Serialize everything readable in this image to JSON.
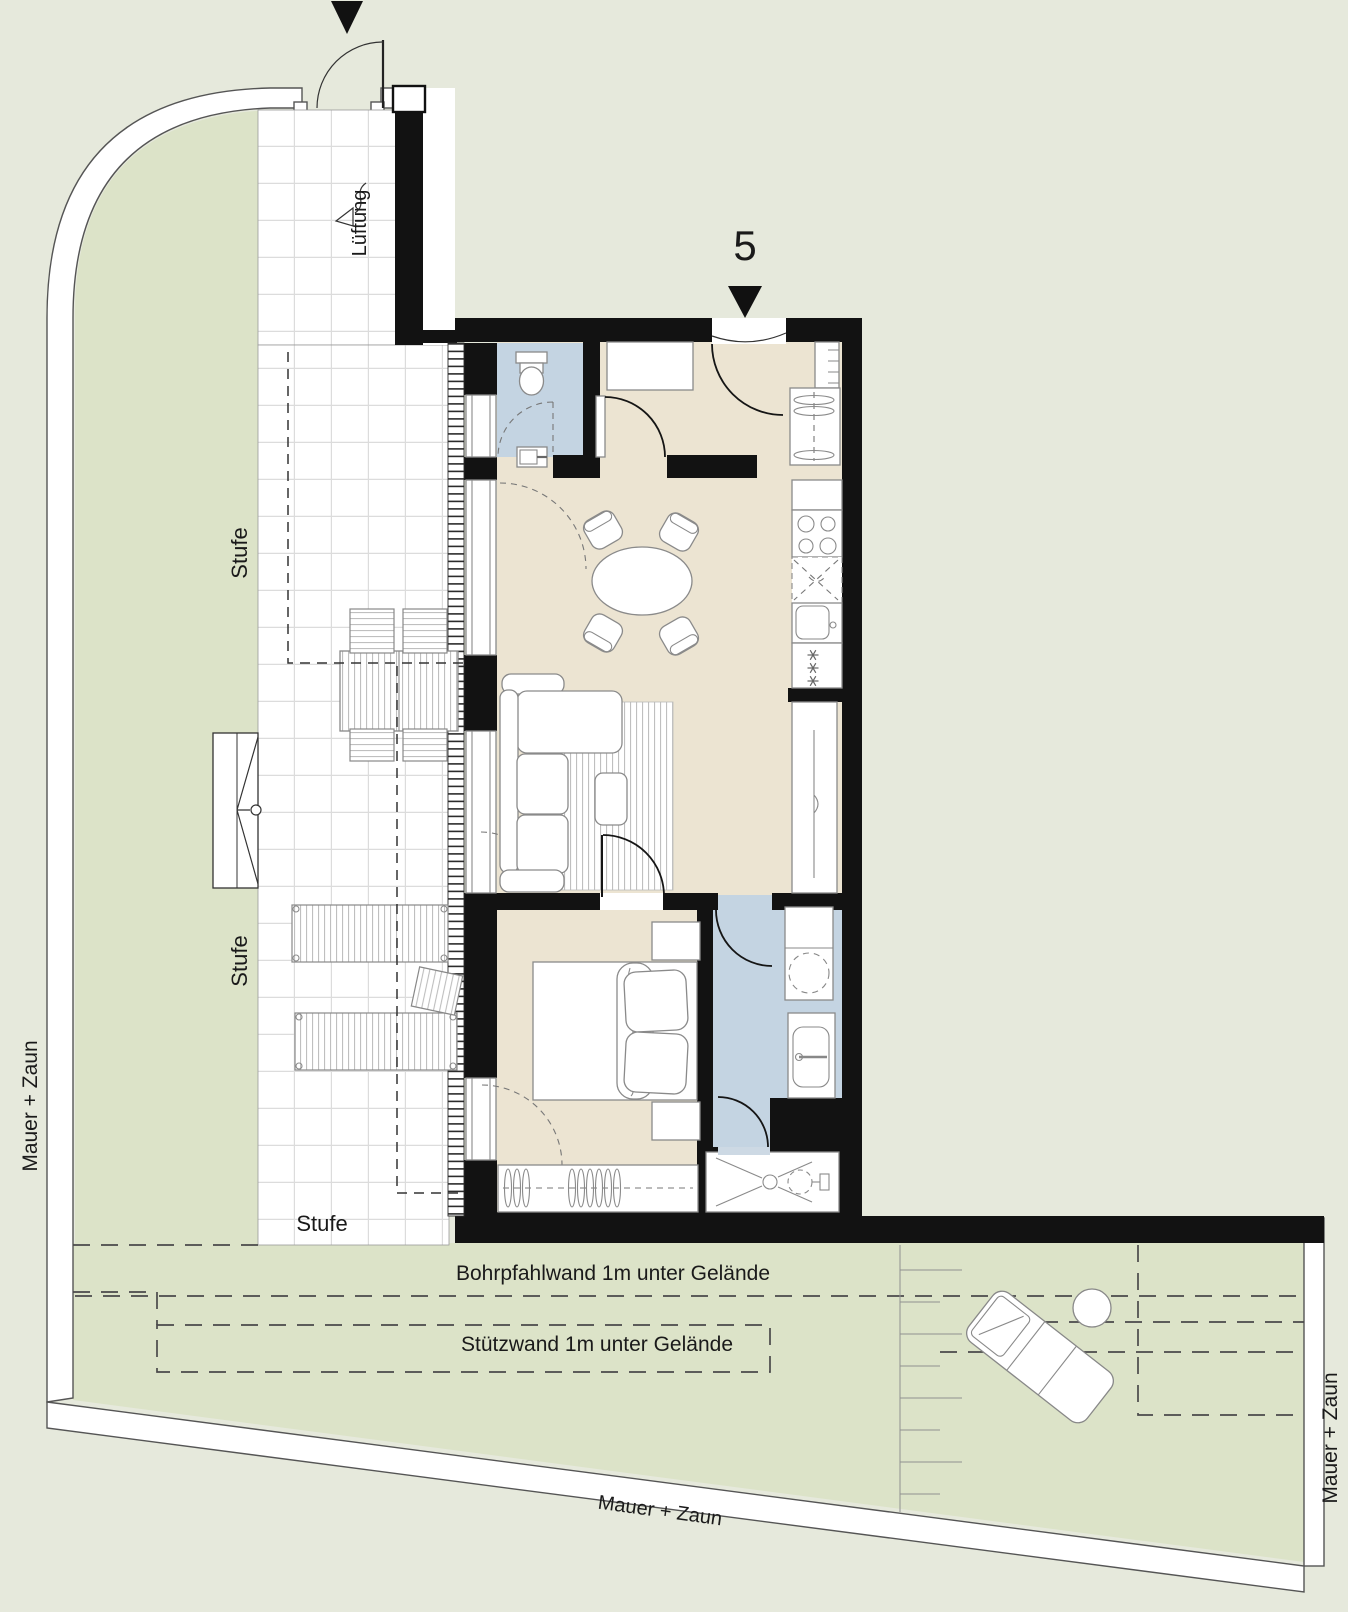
{
  "plan": {
    "unit_number": "5",
    "labels": {
      "ventilation": "Lüftung",
      "step_upper": "Stufe",
      "step_lower": "Stufe",
      "step_bottom": "Stufe",
      "bored_pile_wall": "Bohrpfahlwand 1m unter Gelände",
      "retaining_wall": "Stützwand 1m unter Gelände",
      "wall_fence_left": "Mauer + Zaun",
      "wall_fence_right": "Mauer + Zaun",
      "wall_fence_bottom": "Mauer + Zaun"
    },
    "colors": {
      "background": "#e6e9dc",
      "garden": "#dce3c8",
      "floor_beige": "#ece4d2",
      "wet_room_blue": "#c4d4e2",
      "wall_black": "#121212",
      "terrace_white": "#ffffff",
      "grid_line": "#dcdcdc",
      "furniture_stroke": "#8a8a8a",
      "text": "#1a1a1a"
    }
  }
}
